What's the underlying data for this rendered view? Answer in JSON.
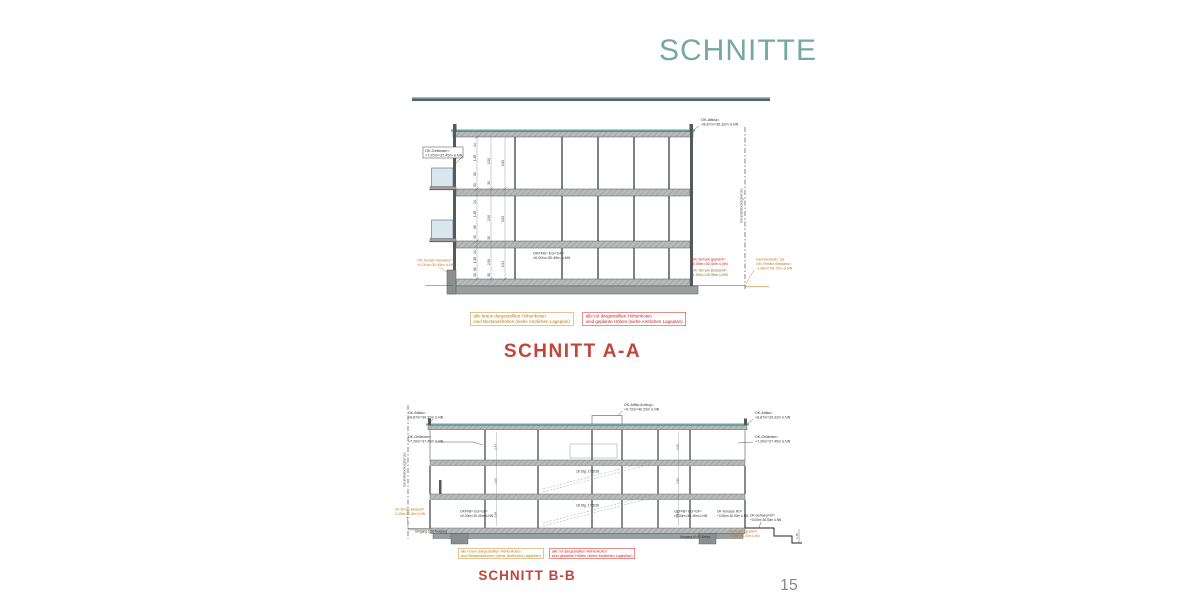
{
  "slide": {
    "title": "SCHNITTE",
    "page_number": "15"
  },
  "legend": {
    "brown": [
      "alle braun dargestellten Höhenkoten",
      "sind Bestandshöhen (siehe Amtlichen Lageplan)"
    ],
    "red": [
      "alle rot dargestellten Höhenkoten",
      "sind geplante Höhen (siehe Amtlichen Lageplan)"
    ]
  },
  "section_aa": {
    "caption": "SCHNITT A-A",
    "boundary_label": "Grundstücksgrenze",
    "ann": {
      "attika": [
        "OK-Attika=",
        "+8.87m=39.32m ü.NN"
      ],
      "gelaender": [
        "OK-Geländer=",
        "+7.20m=37.45m ü.NN"
      ],
      "terrain_bestand_left": [
        "OK-Terrain Bestand=",
        "+0.00m=30.45m ü.NN"
      ],
      "okffb": [
        "OKFFB= EG=GF=",
        "±0.00m=30.45m ü.NN"
      ],
      "terrain_geplant": [
        "OK-Terrain geplant=",
        "-0.05m=30.40m ü.NN"
      ],
      "terrain_bestand_right": [
        "OK-Terrain Bestand=",
        "-1.50m=28.95m ü.NN"
      ],
      "strasse": [
        "Gemeindestr. 2a",
        "OK-Terrain Bestand=",
        "-1.68m=28.73m ü.NN"
      ]
    },
    "dims": {
      "col1": [
        "24",
        "1.38",
        "80",
        "50"
      ],
      "col2": [
        "2.50",
        "30"
      ],
      "col3": [
        "2.62",
        "3.00",
        "2.94"
      ]
    }
  },
  "section_bb": {
    "caption": "SCHNITT B-B",
    "boundary_label": "Grundstücksgrenze",
    "ann": {
      "attika": [
        "OK-Attika=",
        "+8.87m=39.32m ü.NN"
      ],
      "gelaender": [
        "OK-Geländer=",
        "+7.20m=37.45m ü.NN"
      ],
      "aufzug": [
        "OK-Attika Aufzug=",
        "+9.72m=40.20m ü.NN"
      ],
      "okffb": [
        "OKFFB= EG=GF=",
        "±0.00m=30.45m ü.NN"
      ],
      "terrasse": [
        "OK-Terrasse NO=",
        "+0.05m=30.50m ü.NN"
      ],
      "gehweg": [
        "OK-Gehweg NO=",
        "+0.05m=30.50m ü.NN"
      ],
      "terrain_bestand": [
        "OK-Terrain Bestand=",
        "-0.15m=30.30m ü.NN"
      ],
      "terrain_geplant": [
        "OK-Terrain geplant=",
        "-0.05m=30.40m ü.NN"
      ],
      "umgang_left": "Umgang 1:20 Neigung",
      "umgang_right": "Umgang ±0.00 Belag",
      "stair": "18 Stg. 17,5/28",
      "dim_right": "1.15"
    },
    "dims": {
      "left": [
        "2.47",
        "2.66",
        "2.94"
      ],
      "right": [
        "2.66",
        "2.66",
        "2.94"
      ]
    }
  },
  "colors": {
    "accent_teal": "#75a89e",
    "caption_red": "#c2453a",
    "annotation_red": "#cc2222",
    "annotation_brown": "#a06a15",
    "annotation_orange": "#b8791e",
    "roof_teal": "#6fa49c",
    "slab_gray": "#b6bbbb",
    "wall_dark": "#55595c",
    "boundary_line": "#6f5f72"
  }
}
